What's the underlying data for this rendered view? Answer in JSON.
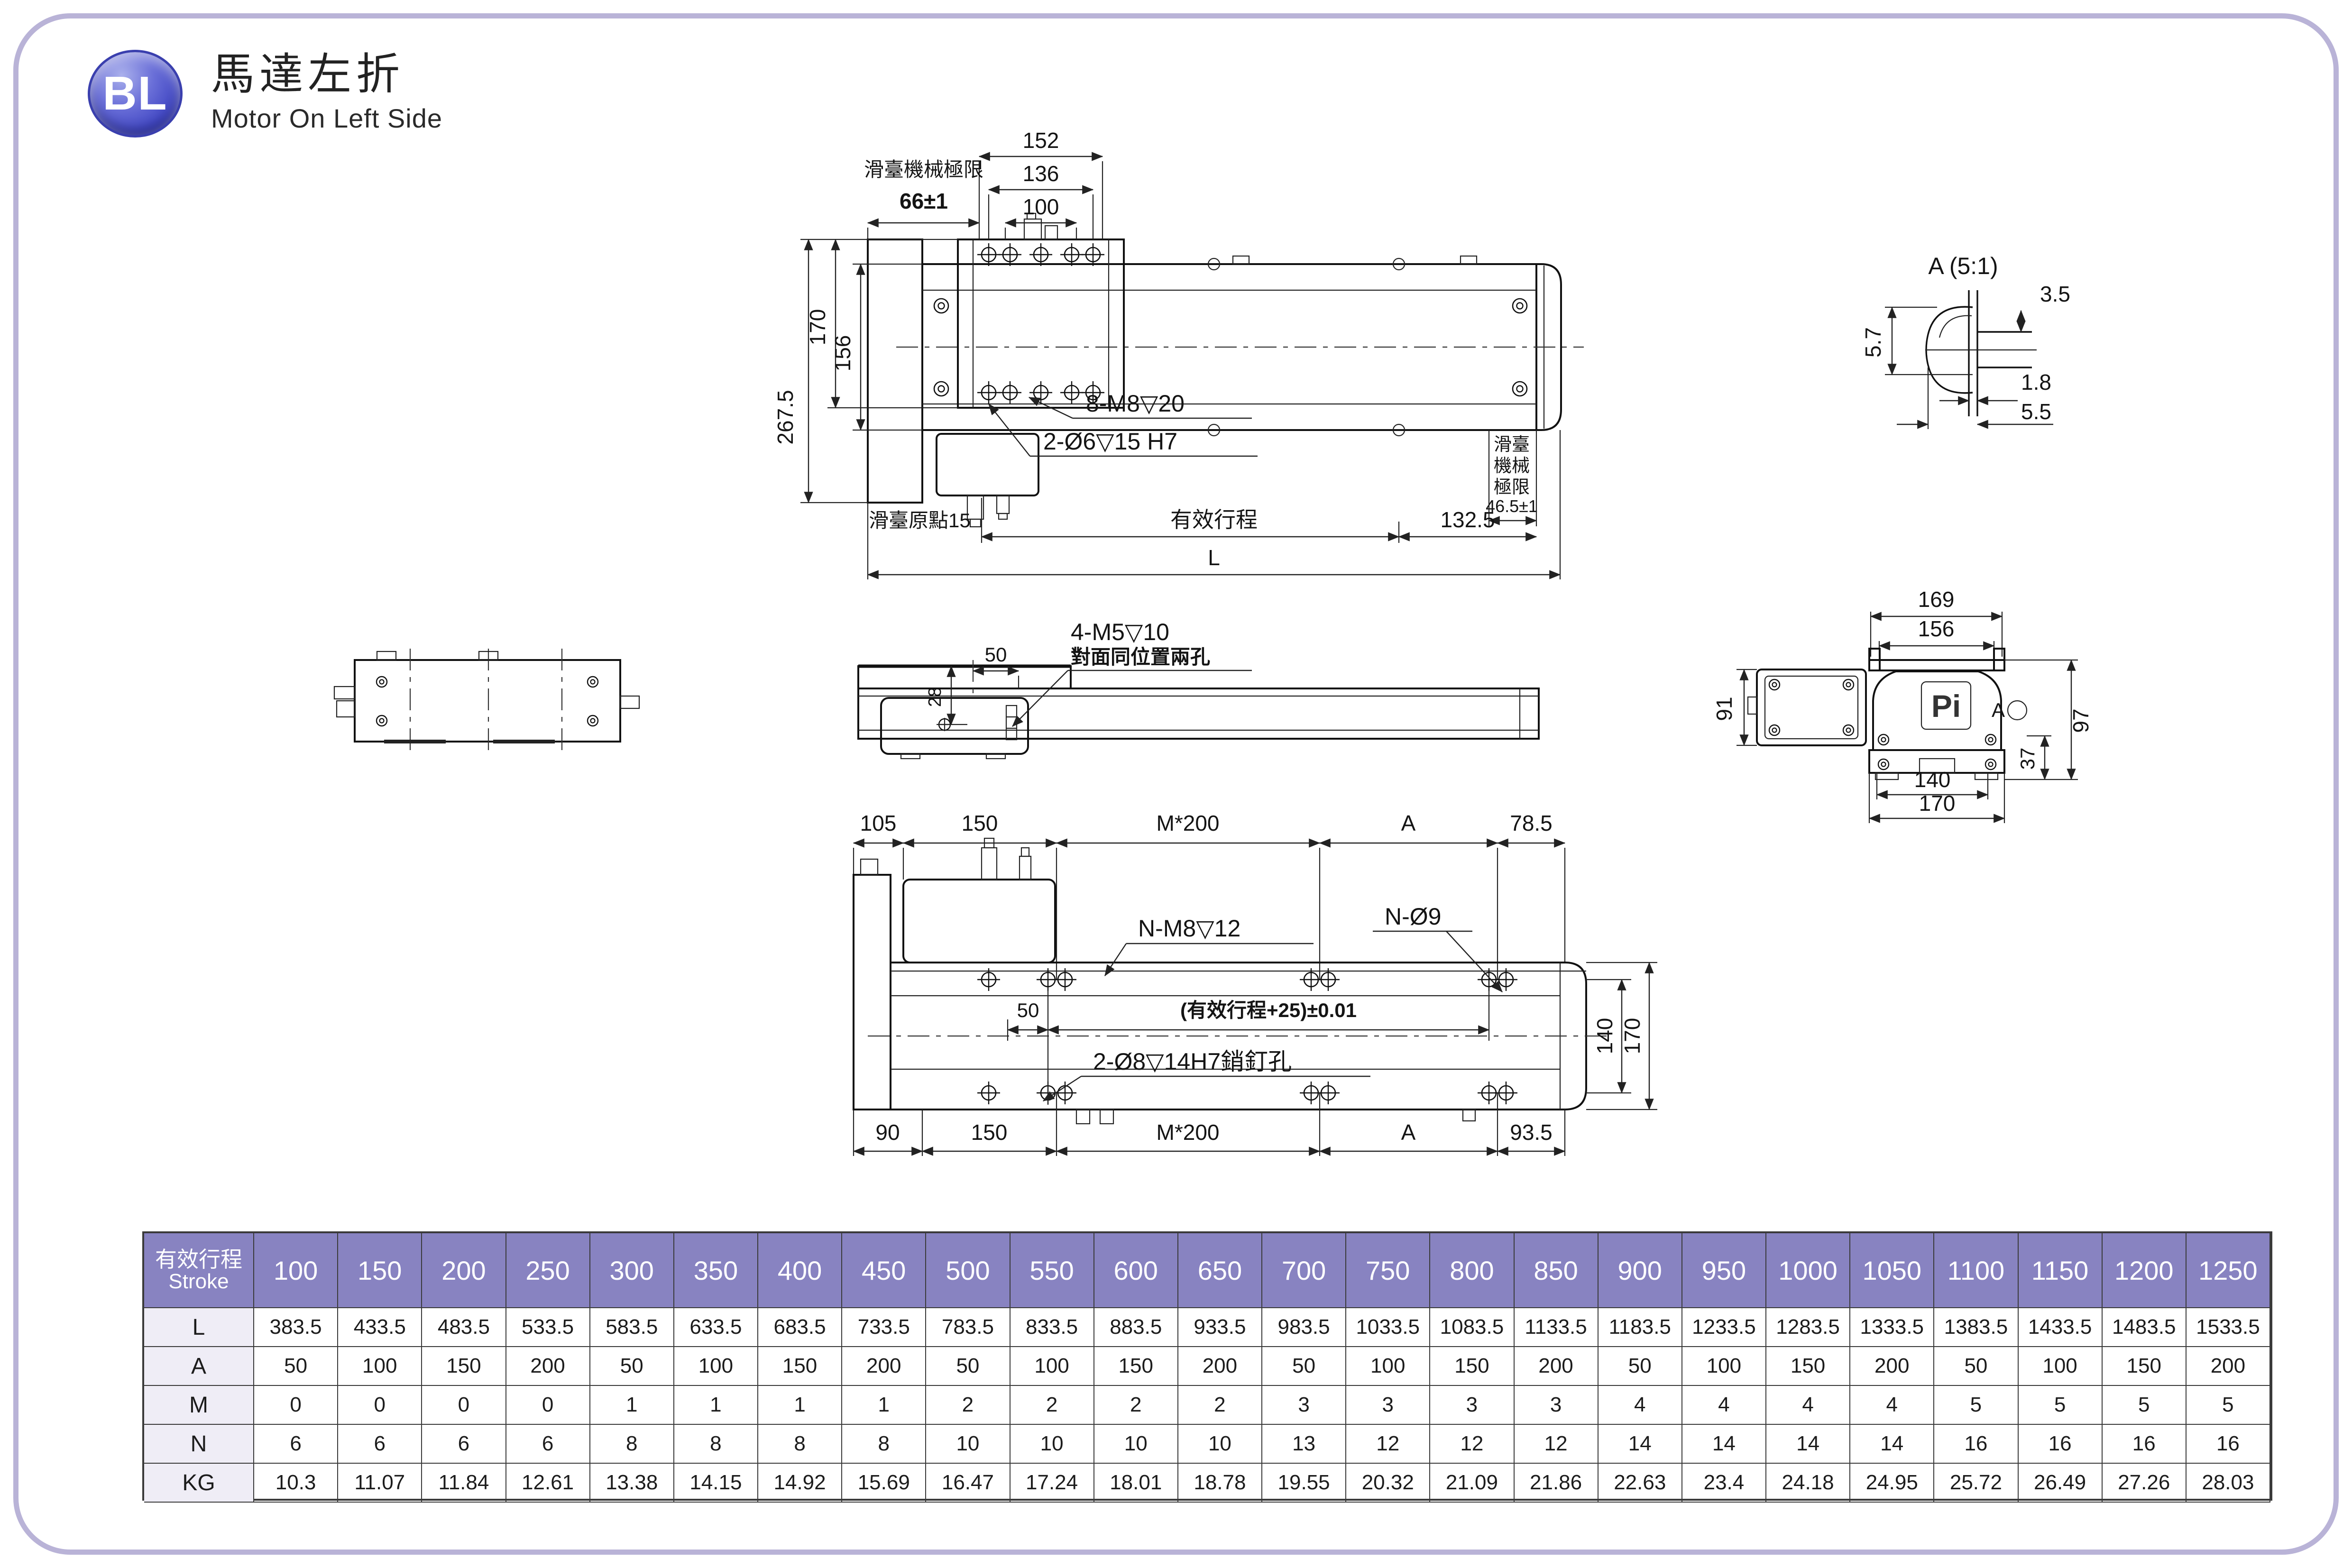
{
  "header": {
    "badge": "BL",
    "title": "馬達左折",
    "subtitle": "Motor On Left Side"
  },
  "colors": {
    "page_border": "#b9b3d7",
    "badge": "#3b41c0",
    "table_header_bg": "#8883c1",
    "table_header_text": "#ffffff",
    "table_row_label_bg": "#efedf6",
    "line": "#1b1b1b"
  },
  "drawings": {
    "top": {
      "d152": "152",
      "d136": "136",
      "d100": "100",
      "d66": "66±1",
      "limit_label": "滑臺機械極限",
      "d2675": "267.5",
      "d170": "170",
      "d156": "156",
      "m8": "8-M8▽20",
      "pin": "2-Ø6▽15 H7",
      "origin": "滑臺原點15",
      "stroke": "有效行程",
      "d1325": "132.5",
      "L": "L",
      "lim1": "滑臺",
      "lim2": "機械",
      "lim3": "極限",
      "d465": "46.5±1"
    },
    "detail": {
      "title": "A (5:1)",
      "d35": "3.5",
      "d57": "5.7",
      "d18": "1.8",
      "d55": "5.5"
    },
    "side": {
      "d50": "50",
      "d28": "28",
      "m5": "4-M5▽10",
      "m5sub": "對面同位置兩孔"
    },
    "end": {
      "d169": "169",
      "d156": "156",
      "d91": "91",
      "d97": "97",
      "d37": "37",
      "d140": "140",
      "d170": "170",
      "logo": "Pi",
      "a": "A"
    },
    "bottom": {
      "d105": "105",
      "d150a": "150",
      "m200a": "M*200",
      "aa": "A",
      "d785": "78.5",
      "nm8": "N-M8▽12",
      "no9": "N-Ø9",
      "d50": "50",
      "tol": "(有效行程+25)±0.01",
      "pin": "2-Ø8▽14H7銷釘孔",
      "d140": "140",
      "d170": "170",
      "d90": "90",
      "d150b": "150",
      "m200b": "M*200",
      "ab": "A",
      "d935": "93.5"
    }
  },
  "table": {
    "label_zh": "有效行程",
    "label_en": "Stroke",
    "strokes": [
      "100",
      "150",
      "200",
      "250",
      "300",
      "350",
      "400",
      "450",
      "500",
      "550",
      "600",
      "650",
      "700",
      "750",
      "800",
      "850",
      "900",
      "950",
      "1000",
      "1050",
      "1100",
      "1150",
      "1200",
      "1250"
    ],
    "rows": [
      {
        "label": "L",
        "values": [
          "383.5",
          "433.5",
          "483.5",
          "533.5",
          "583.5",
          "633.5",
          "683.5",
          "733.5",
          "783.5",
          "833.5",
          "883.5",
          "933.5",
          "983.5",
          "1033.5",
          "1083.5",
          "1133.5",
          "1183.5",
          "1233.5",
          "1283.5",
          "1333.5",
          "1383.5",
          "1433.5",
          "1483.5",
          "1533.5"
        ]
      },
      {
        "label": "A",
        "values": [
          "50",
          "100",
          "150",
          "200",
          "50",
          "100",
          "150",
          "200",
          "50",
          "100",
          "150",
          "200",
          "50",
          "100",
          "150",
          "200",
          "50",
          "100",
          "150",
          "200",
          "50",
          "100",
          "150",
          "200"
        ]
      },
      {
        "label": "M",
        "values": [
          "0",
          "0",
          "0",
          "0",
          "1",
          "1",
          "1",
          "1",
          "2",
          "2",
          "2",
          "2",
          "3",
          "3",
          "3",
          "3",
          "4",
          "4",
          "4",
          "4",
          "5",
          "5",
          "5",
          "5"
        ]
      },
      {
        "label": "N",
        "values": [
          "6",
          "6",
          "6",
          "6",
          "8",
          "8",
          "8",
          "8",
          "10",
          "10",
          "10",
          "10",
          "13",
          "12",
          "12",
          "12",
          "14",
          "14",
          "14",
          "14",
          "16",
          "16",
          "16",
          "16"
        ]
      },
      {
        "label": "KG",
        "values": [
          "10.3",
          "11.07",
          "11.84",
          "12.61",
          "13.38",
          "14.15",
          "14.92",
          "15.69",
          "16.47",
          "17.24",
          "18.01",
          "18.78",
          "19.55",
          "20.32",
          "21.09",
          "21.86",
          "22.63",
          "23.4",
          "24.18",
          "24.95",
          "25.72",
          "26.49",
          "27.26",
          "28.03"
        ]
      }
    ]
  }
}
